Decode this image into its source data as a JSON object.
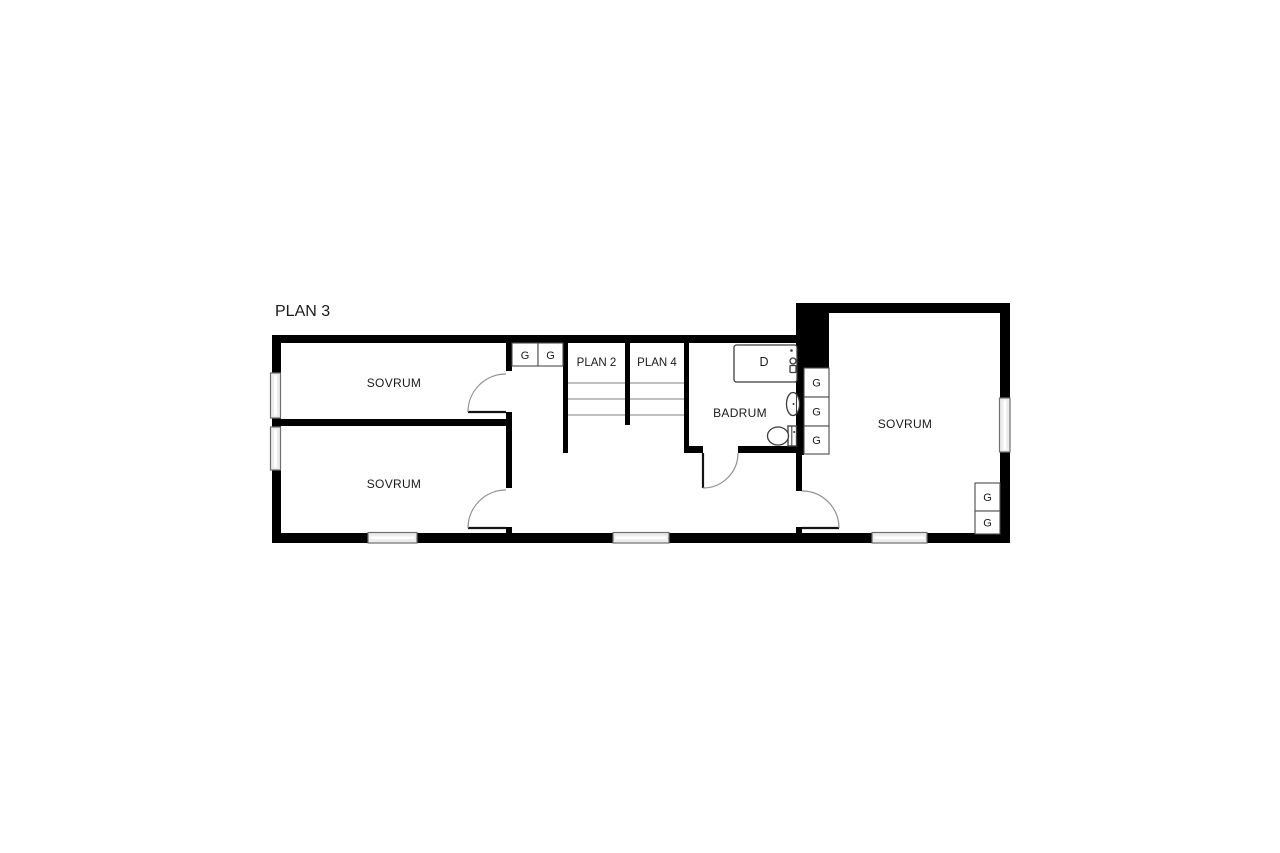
{
  "title": "PLAN 3",
  "rooms": [
    {
      "name": "sovrum-top-left",
      "label": "SOVRUM"
    },
    {
      "name": "sovrum-bottom-left",
      "label": "SOVRUM"
    },
    {
      "name": "badrum",
      "label": "BADRUM"
    },
    {
      "name": "sovrum-right",
      "label": "SOVRUM"
    }
  ],
  "stairs": {
    "flights": [
      {
        "label": "PLAN 2"
      },
      {
        "label": "PLAN 4"
      }
    ]
  },
  "fixtures": [
    {
      "name": "shower",
      "label": "D"
    }
  ],
  "closets": [
    {
      "label": "G"
    },
    {
      "label": "G"
    },
    {
      "label": "G"
    },
    {
      "label": "G"
    },
    {
      "label": "G"
    },
    {
      "label": "G"
    },
    {
      "label": "G"
    }
  ],
  "colors": {
    "background": "#ffffff",
    "wall": "#000000",
    "window_fill": "#ececec",
    "window_stroke": "#6e6e6e",
    "stair_line": "#9a9a9a",
    "door_arc": "#909090",
    "fixture_stroke": "#3c3c3c",
    "text": "#1a1a1a"
  }
}
